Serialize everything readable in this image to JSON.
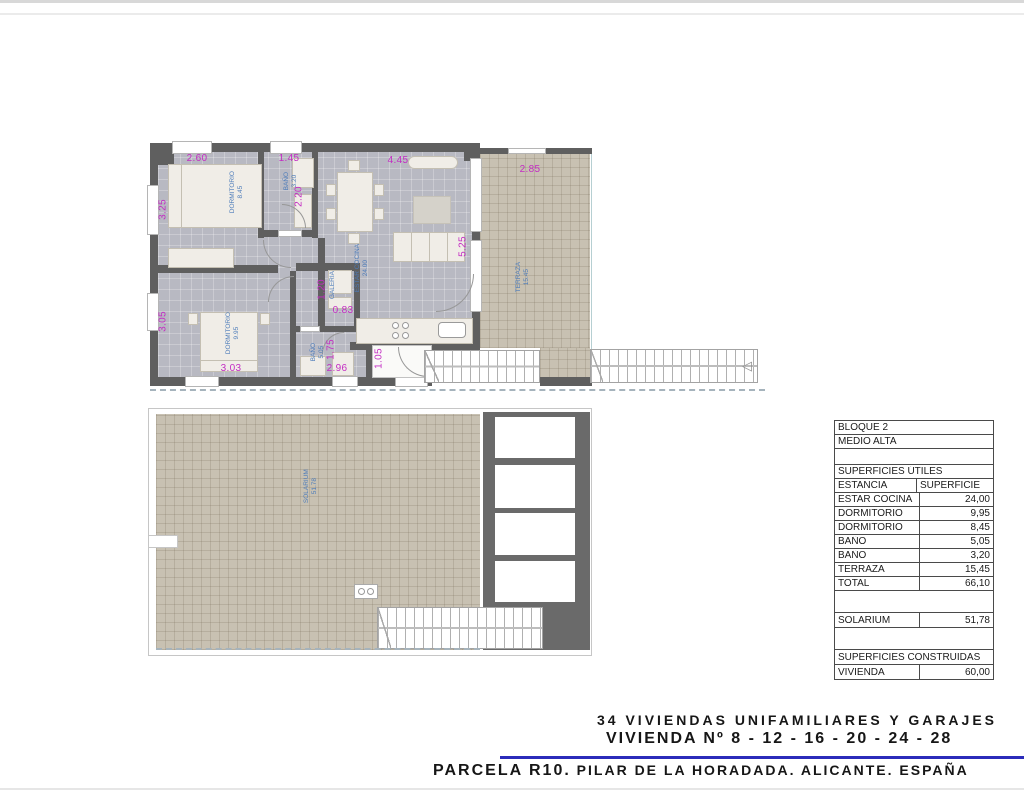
{
  "titles": {
    "line1": "34 VIVIENDAS UNIFAMILIARES Y GARAJES",
    "line2": "VIVIENDA Nº 8 - 12 - 16 - 20 - 24 - 28",
    "line3_lead": "PARCELA R10.",
    "line3_rest": " PILAR DE LA HORADADA. ALICANTE. ESPAÑA"
  },
  "plans": {
    "upper": {
      "rooms": {
        "dorm1": {
          "name": "DORMITORIO",
          "area": "8.45"
        },
        "bath1": {
          "name": "BAÑO",
          "area": "3.20"
        },
        "living": {
          "name": "ESTAR COCINA",
          "area": "24.00"
        },
        "galeria": {
          "name": "GALERIA"
        },
        "dorm2": {
          "name": "DORMITORIO",
          "area": "9.95"
        },
        "bath2": {
          "name": "BAÑO",
          "area": "5.05"
        },
        "terraza": {
          "name": "TERRAZA",
          "area": "15.45"
        }
      },
      "dims": {
        "dorm1_w": "2.60",
        "dorm1_h": "3.25",
        "bath1_w": "1.45",
        "bath1_h": "2.20",
        "living_w": "4.45",
        "living_h": "5.25",
        "terraza_w": "2.85",
        "galeria_h": "1.20",
        "galeria_w": "0.83",
        "dorm2_h": "3.05",
        "dorm2_w": "3.03",
        "bath2_h": "1.75",
        "bath2_w": "2.96",
        "hall_w": "1.05"
      }
    },
    "lower": {
      "rooms": {
        "solarium": {
          "name": "SOLARIUM",
          "area": "51.78"
        }
      }
    }
  },
  "table": {
    "title1": "BLOQUE 2",
    "title2": "MEDIO ALTA",
    "section_useful": "SUPERFICIES ÚTILES",
    "col_room": "ESTANCIA",
    "col_area": "SUPERFICIE",
    "rows": [
      {
        "label": "ESTAR COCINA",
        "value": "24,00"
      },
      {
        "label": "DORMITORIO",
        "value": "9,95"
      },
      {
        "label": "DORMITORIO",
        "value": "8,45"
      },
      {
        "label": "BAÑO",
        "value": "5,05"
      },
      {
        "label": "BAÑO",
        "value": "3,20"
      },
      {
        "label": "TERRAZA",
        "value": "15,45"
      },
      {
        "label": "TOTAL",
        "value": "66,10"
      }
    ],
    "solarium_row": {
      "label": "SOLARIUM",
      "value": "51,78"
    },
    "section_built": "SUPERFICIES CONSTRUIDAS",
    "built_row": {
      "label": "VIVIENDA",
      "value": "60,00"
    }
  },
  "colors": {
    "accent_rule": "#2b2bba",
    "dimension_text": "#c32cc3",
    "room_label_text": "#4d7cba",
    "wall": "#5f5f5f",
    "floor": "#b8b9c2",
    "terrace_tile": "#c8c1b2"
  }
}
